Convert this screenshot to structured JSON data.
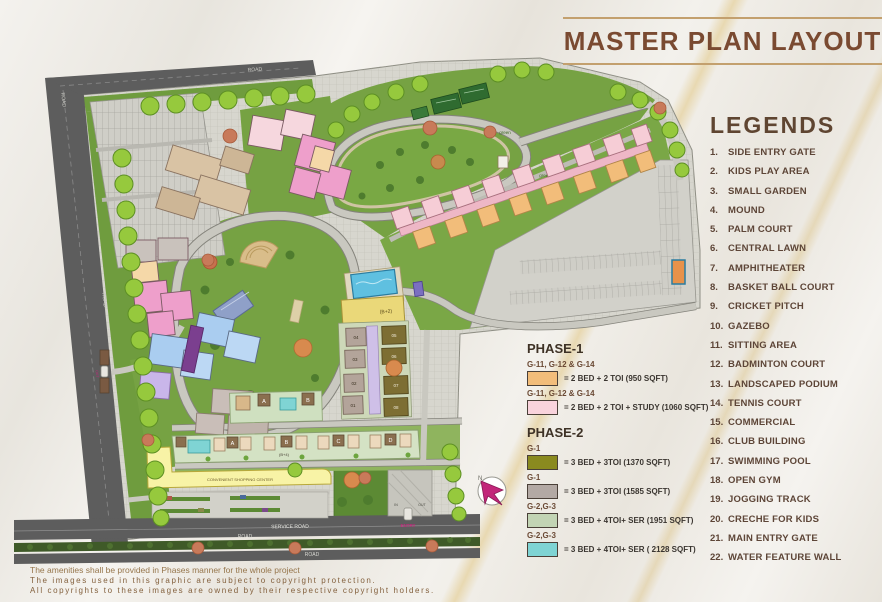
{
  "title": "MASTER PLAN LAYOUT",
  "legends": {
    "heading": "LEGENDS",
    "items": [
      {
        "num": "1.",
        "label": "SIDE ENTRY GATE"
      },
      {
        "num": "2.",
        "label": "KIDS PLAY AREA"
      },
      {
        "num": "3.",
        "label": "SMALL GARDEN"
      },
      {
        "num": "4.",
        "label": "MOUND"
      },
      {
        "num": "5.",
        "label": "PALM COURT"
      },
      {
        "num": "6.",
        "label": "CENTRAL LAWN"
      },
      {
        "num": "7.",
        "label": "AMPHITHEATER"
      },
      {
        "num": "8.",
        "label": "BASKET BALL COURT"
      },
      {
        "num": "9.",
        "label": "CRICKET PITCH"
      },
      {
        "num": "10.",
        "label": "GAZEBO"
      },
      {
        "num": "11.",
        "label": "SITTING AREA"
      },
      {
        "num": "12.",
        "label": "BADMINTON COURT"
      },
      {
        "num": "13.",
        "label": "LANDSCAPED PODIUM"
      },
      {
        "num": "14.",
        "label": "TENNIS COURT"
      },
      {
        "num": "15.",
        "label": "COMMERCIAL"
      },
      {
        "num": "16.",
        "label": "CLUB BUILDING"
      },
      {
        "num": "17.",
        "label": "SWIMMING POOL"
      },
      {
        "num": "18.",
        "label": "OPEN GYM"
      },
      {
        "num": "19.",
        "label": "JOGGING TRACK"
      },
      {
        "num": "20.",
        "label": "CRECHE FOR KIDS"
      },
      {
        "num": "21.",
        "label": "MAIN ENTRY GATE"
      },
      {
        "num": "22.",
        "label": "WATER FEATURE WALL"
      }
    ]
  },
  "phases": {
    "phase1": {
      "heading": "PHASE-1",
      "items": [
        {
          "group": "G-11, G-12 & G-14",
          "swatch": "#f2bd7a",
          "desc": "= 2 BED + 2 TOI (950 SQFT)"
        },
        {
          "group": "G-11, G-12 & G-14",
          "swatch": "#f9d3dc",
          "desc": "= 2 BED + 2 TOI + STUDY (1060 SQFT)"
        }
      ]
    },
    "phase2": {
      "heading": "PHASE-2",
      "items": [
        {
          "group": "G-1",
          "swatch": "#8a8a1f",
          "desc": "= 3 BED + 3TOI (1370 SQFT)"
        },
        {
          "group": "G-1",
          "swatch": "#b3a9a4",
          "desc": "= 3 BED + 3TOI (1585 SQFT)"
        },
        {
          "group": "G-2,G-3",
          "swatch": "#c2d4b4",
          "desc": "= 3 BED + 4TOI+ SER (1951 SQFT)"
        },
        {
          "group": "G-2,G-3",
          "swatch": "#7fd4d4",
          "desc": "= 3 BED + 4TOI+ SER ( 2128 SQFT)"
        }
      ]
    }
  },
  "footer": {
    "line1": "The amenities shall be provided in Phases manner for the whole project",
    "line2": "The images used in this graphic are subject to copyright protection.",
    "line3": "All copyrights to these images are owned by their respective copyright holders."
  },
  "map": {
    "labels": {
      "road": "ROAD",
      "service_road": "SERVICE ROAD",
      "entry": "ENTRY",
      "in": "IN",
      "out": "OUT",
      "shopping": "CONVENIENT SHOPPING CENTER",
      "club": "(B+2)",
      "row": "(B+4)",
      "green": "green",
      "north": "N"
    },
    "towers": {
      "letters": [
        "A",
        "B",
        "C",
        "D"
      ],
      "units": [
        "01",
        "02",
        "03",
        "04",
        "05",
        "06",
        "07",
        "08"
      ]
    }
  },
  "colors": {
    "title_brown": "#7a4a31",
    "legend_brown": "#5d4537",
    "road_dark": "#5d5d5d",
    "paving": "#d7d6ce",
    "lawn_green": "#76a243",
    "tree_green": "#96c93d",
    "pool_blue": "#5fc0e0",
    "shopping_yellow": "#f8f3a6",
    "compass_magenta": "#c2267a"
  }
}
